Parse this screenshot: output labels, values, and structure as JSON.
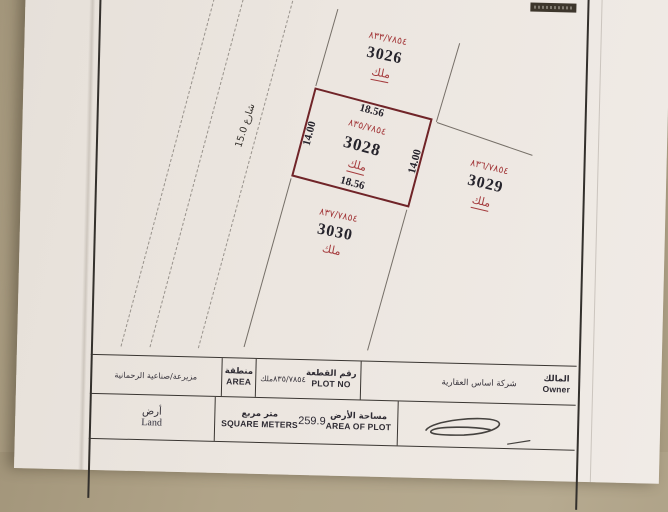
{
  "document": {
    "street": {
      "label": "شارع 15.0"
    },
    "plots": {
      "p3026": {
        "ref": "٨٣٣/٧٨٥٤",
        "id": "3026",
        "owner": "ملك"
      },
      "p3028": {
        "ref": "٨٣٥/٧٨٥٤",
        "id": "3028",
        "owner": "ملك",
        "dim_top": "18.56",
        "dim_bottom": "18.56",
        "dim_left": "14.00",
        "dim_right": "14.00"
      },
      "p3029": {
        "ref": "٨٣٦/٧٨٥٤",
        "id": "3029",
        "owner": "ملك"
      },
      "p3030": {
        "ref": "٨٣٧/٧٨٥٤",
        "id": "3030",
        "owner": "ملك"
      }
    },
    "title_block": {
      "area": {
        "label_ar": "منطقة",
        "label_en": "AREA",
        "value": "مزيرعة/صناعية الرحمانية"
      },
      "plot_no": {
        "label_ar": "رقم القطعة",
        "label_en": "PLOT NO",
        "value_prefix": "ملك",
        "value": "٨٣٥/٧٨٥٤"
      },
      "owner": {
        "label_ar": "المالك",
        "label_en": "Owner",
        "value": "شركة اساس العقارية"
      },
      "land": {
        "label_ar": "أرض",
        "label_en": "Land"
      },
      "square_meters": {
        "label_ar": "متر مربع",
        "label_en": "SQUARE METERS",
        "value": "259.9"
      },
      "area_of_plot": {
        "label_ar": "مساحة الأرض",
        "label_en": "AREA OF PLOT"
      }
    },
    "colors": {
      "accent_red": "#a43a3c",
      "plot_border": "#702428",
      "paper": "#ebe5df",
      "background": "#b1a489"
    }
  }
}
